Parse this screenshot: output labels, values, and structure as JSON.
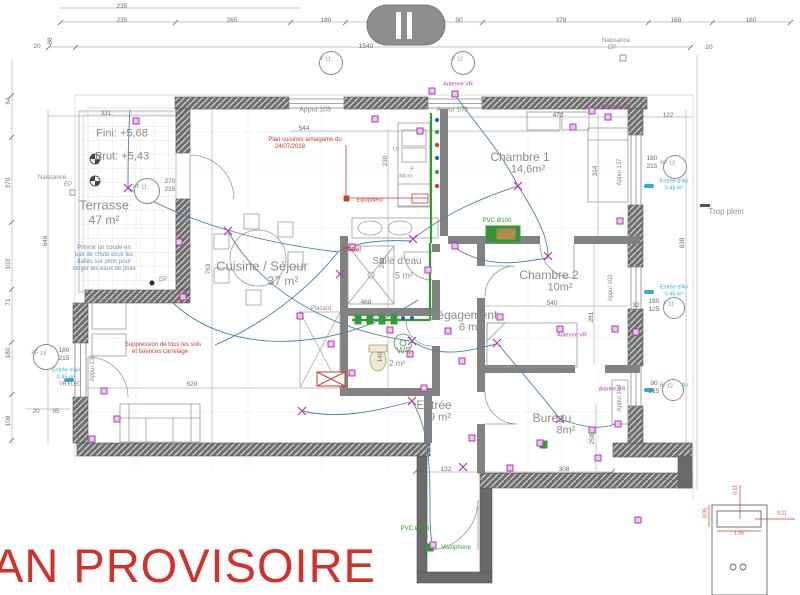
{
  "stamp": {
    "text": "AN PROVISOIRE",
    "color": "#d3302a"
  },
  "notes": {
    "level_fini": "Fini: +5,68",
    "level_brut": "Brut: +5,43",
    "kitchen_plan": [
      "Plan cuisines amalgame du",
      "24/07/2018"
    ],
    "rain_note": [
      "Prévoir un coude en",
      "bas de chute sous les",
      "dalles sur plots pour",
      "diriger les eaux de pluie"
    ],
    "floor_note": [
      "Suppression de tous les sols",
      "et faïences carrelage"
    ]
  },
  "rooms": [
    {
      "n": "Terrasse",
      "a": "47 m²",
      "nx": 104,
      "ny": 205,
      "ax": 104,
      "ay": 220,
      "s": 13
    },
    {
      "n": "Cuisine / Séjour",
      "a": "37 m²",
      "nx": 262,
      "ny": 266,
      "ax": 283,
      "ay": 281,
      "s": 13
    },
    {
      "n": "Salle d'eau",
      "a": "5 m²",
      "nx": 397,
      "ny": 262,
      "ax": 404,
      "ay": 276,
      "s": 10
    },
    {
      "n": "WC",
      "a": "2 m²",
      "nx": 404,
      "ny": 351,
      "ax": 397,
      "ay": 364,
      "s": 9
    },
    {
      "n": "Chambre 1",
      "a": "14,6m²",
      "nx": 520,
      "ny": 157,
      "ax": 528,
      "ay": 170,
      "s": 12
    },
    {
      "n": "Chambre 2",
      "a": "10m²",
      "nx": 549,
      "ny": 275,
      "ax": 560,
      "ay": 288,
      "s": 12
    },
    {
      "n": "Dégagement",
      "a": "6 m²",
      "nx": 463,
      "ny": 315,
      "ax": 470,
      "ay": 328,
      "s": 12
    },
    {
      "n": "Entrée",
      "a": "9 m²",
      "nx": 434,
      "ny": 405,
      "ax": 440,
      "ay": 418,
      "s": 12
    },
    {
      "n": "Bureau",
      "a": "8m²",
      "nx": 552,
      "ny": 418,
      "ax": 566,
      "ay": 431,
      "s": 12
    },
    {
      "n": "Placard",
      "a": "",
      "nx": 321,
      "ny": 309,
      "s": 6
    }
  ],
  "annotations": [
    {
      "t": "Fini: +5,68",
      "x": 122,
      "y": 134,
      "c": "gray",
      "s": 11
    },
    {
      "t": "Brut: +5,43",
      "x": 122,
      "y": 157,
      "c": "gray",
      "s": 11
    },
    {
      "t": "Naissance",
      "x": 52,
      "y": 178,
      "c": "gray",
      "s": 6
    },
    {
      "t": "EP",
      "x": 68,
      "y": 185,
      "c": "gray",
      "s": 6
    },
    {
      "t": "Naissance",
      "x": 616,
      "y": 41,
      "c": "gray",
      "s": 6
    },
    {
      "t": "EP",
      "x": 612,
      "y": 48,
      "c": "gray",
      "s": 6
    },
    {
      "t": "EP",
      "x": 163,
      "y": 280,
      "c": "gray",
      "s": 6
    },
    {
      "t": "Trop plein",
      "x": 726,
      "y": 212,
      "c": "gray2",
      "s": 8
    },
    {
      "t": "Prévoir un coude en",
      "x": 104,
      "y": 248,
      "c": "blue",
      "s": 6
    },
    {
      "t": "bas de chute sous les",
      "x": 104,
      "y": 255,
      "c": "blue",
      "s": 6
    },
    {
      "t": "dalles sur plots pour",
      "x": 104,
      "y": 262,
      "c": "blue",
      "s": 6
    },
    {
      "t": "diriger les eaux de pluie",
      "x": 104,
      "y": 269,
      "c": "blue",
      "s": 6
    },
    {
      "t": "Suppression de tous les sols",
      "x": 163,
      "y": 345,
      "c": "red",
      "s": 6
    },
    {
      "t": "et faïences carrelage",
      "x": 160,
      "y": 352,
      "c": "red",
      "s": 6
    },
    {
      "t": "Plan cuisines amalgame du",
      "x": 305,
      "y": 140,
      "c": "red",
      "s": 6
    },
    {
      "t": "24/07/2018",
      "x": 290,
      "y": 147,
      "c": "red",
      "s": 6
    },
    {
      "t": "Equipateur",
      "x": 370,
      "y": 201,
      "c": "red",
      "s": 5.5
    },
    {
      "t": "Détail",
      "x": 352,
      "y": 250,
      "c": "red",
      "s": 7
    },
    {
      "t": "Appui 103",
      "x": 315,
      "y": 110,
      "c": "gray",
      "s": 7
    },
    {
      "t": "Appui 103",
      "x": 452,
      "y": 110,
      "c": "gray",
      "s": 7
    },
    {
      "t": "Appui 131",
      "x": 93,
      "y": 368,
      "c": "gray",
      "s": 6,
      "r": -90
    },
    {
      "t": "Appui 102",
      "x": 611,
      "y": 288,
      "c": "gray",
      "s": 6,
      "r": -90
    },
    {
      "t": "Appui 137",
      "x": 620,
      "y": 172,
      "c": "gray",
      "s": 6,
      "r": -90
    },
    {
      "t": "Appui 104",
      "x": 620,
      "y": 398,
      "c": "gray",
      "s": 6,
      "r": -90
    },
    {
      "t": "Antenne VR",
      "x": 458,
      "y": 85,
      "c": "purple",
      "s": 5.5
    },
    {
      "t": "Antenne VR",
      "x": 616,
      "y": 108,
      "c": "purple",
      "s": 5.5
    },
    {
      "t": "Antenne VR",
      "x": 572,
      "y": 336,
      "c": "purple",
      "s": 5.5
    },
    {
      "t": "Alarme VR",
      "x": 612,
      "y": 390,
      "c": "purple",
      "s": 5.5
    },
    {
      "t": "VR ELEC",
      "x": 70,
      "y": 385,
      "c": "purple",
      "s": 5
    },
    {
      "t": "PVC Ø100",
      "x": 497,
      "y": 221,
      "c": "green",
      "s": 6
    },
    {
      "t": "PVC Ø100",
      "x": 415,
      "y": 529,
      "c": "green",
      "s": 6
    },
    {
      "t": "Visiophone",
      "x": 456,
      "y": 548,
      "c": "green",
      "s": 6
    },
    {
      "t": "LV",
      "x": 396,
      "y": 150,
      "c": "gray",
      "s": 5.5
    },
    {
      "t": "F",
      "x": 412,
      "y": 170,
      "c": "gray",
      "s": 5.5
    },
    {
      "t": "Micro",
      "x": 406,
      "y": 177,
      "c": "gray",
      "s": 5.5
    },
    {
      "t": "0.11",
      "x": 736,
      "y": 490,
      "c": "red",
      "s": 5,
      "r": -90
    },
    {
      "t": "0.05",
      "x": 706,
      "y": 513,
      "c": "red",
      "s": 5,
      "r": -90
    },
    {
      "t": "1.06",
      "x": 739,
      "y": 534,
      "c": "red",
      "s": 5
    },
    {
      "t": "0.11",
      "x": 782,
      "y": 514,
      "c": "red",
      "s": 5
    }
  ],
  "dimensions": [
    {
      "t": "235",
      "x": 122,
      "y": 7
    },
    {
      "t": "235",
      "x": 122,
      "y": 21
    },
    {
      "t": "265",
      "x": 232,
      "y": 21
    },
    {
      "t": "180",
      "x": 326,
      "y": 21
    },
    {
      "t": "90",
      "x": 459,
      "y": 21
    },
    {
      "t": "378",
      "x": 561,
      "y": 21
    },
    {
      "t": "168",
      "x": 676,
      "y": 21
    },
    {
      "t": "180",
      "x": 751,
      "y": 21
    },
    {
      "t": "1540",
      "x": 366,
      "y": 47
    },
    {
      "t": "20",
      "x": 37,
      "y": 47
    },
    {
      "t": "20",
      "x": 709,
      "y": 48
    },
    {
      "t": "88",
      "x": 51,
      "y": 41,
      "r": -90
    },
    {
      "t": "544",
      "x": 304,
      "y": 129
    },
    {
      "t": "331",
      "x": 106,
      "y": 114
    },
    {
      "t": "472",
      "x": 558,
      "y": 116
    },
    {
      "t": "122",
      "x": 668,
      "y": 116
    },
    {
      "t": "64",
      "x": 9,
      "y": 101,
      "r": -90
    },
    {
      "t": "370",
      "x": 9,
      "y": 183,
      "r": -90
    },
    {
      "t": "103",
      "x": 9,
      "y": 264,
      "r": -90
    },
    {
      "t": "71",
      "x": 9,
      "y": 302,
      "r": -90
    },
    {
      "t": "180",
      "x": 9,
      "y": 353,
      "r": -90
    },
    {
      "t": "108",
      "x": 9,
      "y": 421,
      "r": -90
    },
    {
      "t": "649",
      "x": 46,
      "y": 241,
      "r": -90
    },
    {
      "t": "763",
      "x": 209,
      "y": 269,
      "r": -90
    },
    {
      "t": "270",
      "x": 170,
      "y": 182
    },
    {
      "t": "215",
      "x": 170,
      "y": 190
    },
    {
      "t": "180",
      "x": 64,
      "y": 351
    },
    {
      "t": "215",
      "x": 64,
      "y": 359
    },
    {
      "t": "180",
      "x": 652,
      "y": 159
    },
    {
      "t": "215",
      "x": 652,
      "y": 167
    },
    {
      "t": "32",
      "x": 636,
      "y": 306
    },
    {
      "t": "180",
      "x": 654,
      "y": 302
    },
    {
      "t": "125",
      "x": 654,
      "y": 310
    },
    {
      "t": "90",
      "x": 654,
      "y": 384
    },
    {
      "t": "215",
      "x": 654,
      "y": 392
    },
    {
      "t": "314",
      "x": 596,
      "y": 171,
      "r": -90
    },
    {
      "t": "230",
      "x": 386,
      "y": 161,
      "r": -90
    },
    {
      "t": "240",
      "x": 383,
      "y": 263,
      "r": -90
    },
    {
      "t": "140",
      "x": 381,
      "y": 357,
      "r": -90
    },
    {
      "t": "540",
      "x": 552,
      "y": 304
    },
    {
      "t": "281",
      "x": 592,
      "y": 317,
      "r": -90
    },
    {
      "t": "468",
      "x": 366,
      "y": 303
    },
    {
      "t": "520",
      "x": 192,
      "y": 385
    },
    {
      "t": "132",
      "x": 446,
      "y": 470
    },
    {
      "t": "308",
      "x": 564,
      "y": 470
    },
    {
      "t": "258",
      "x": 593,
      "y": 439,
      "r": -90
    },
    {
      "t": "638",
      "x": 683,
      "y": 243,
      "r": -90
    },
    {
      "t": "20",
      "x": 36,
      "y": 412
    },
    {
      "t": "95",
      "x": 56,
      "y": 412
    }
  ],
  "window_marks": [
    {
      "l": "F 11",
      "x": 330,
      "y": 62,
      "r": 11
    },
    {
      "l": "F 12",
      "x": 462,
      "y": 62,
      "r": 11
    },
    {
      "l": "PF 11",
      "x": 146,
      "y": 190,
      "r": 12
    },
    {
      "l": "PF 13",
      "x": 45,
      "y": 356,
      "r": 12
    },
    {
      "l": "PF 13",
      "x": 674,
      "y": 166,
      "r": 11
    },
    {
      "l": "F 11",
      "x": 673,
      "y": 307,
      "r": 10
    },
    {
      "l": "F 12",
      "x": 672,
      "y": 389,
      "r": 10
    }
  ],
  "air_inlets": [
    {
      "l1": "Entrée d'Air",
      "l2": "0.45 m²",
      "x": 66,
      "y": 371
    },
    {
      "l1": "Entrée d'Air",
      "l2": "0.45 m²",
      "x": 674,
      "y": 182
    },
    {
      "l1": "Entrée d'Air",
      "l2": "0.45 m²",
      "x": 674,
      "y": 288
    },
    {
      "l1": "Entrée d'Air",
      "l2": "0.45 m²",
      "x": 674,
      "y": 386
    }
  ],
  "colors": {
    "wall": "#6a6a6a",
    "interior_wall": "#828282",
    "wire": "#4d7fae",
    "plumbing": "#2f9e2f",
    "electric": "#b03ab0",
    "air": "#2fb0c6",
    "note_red": "#cc3a32",
    "stamp_red": "#d3302a"
  }
}
